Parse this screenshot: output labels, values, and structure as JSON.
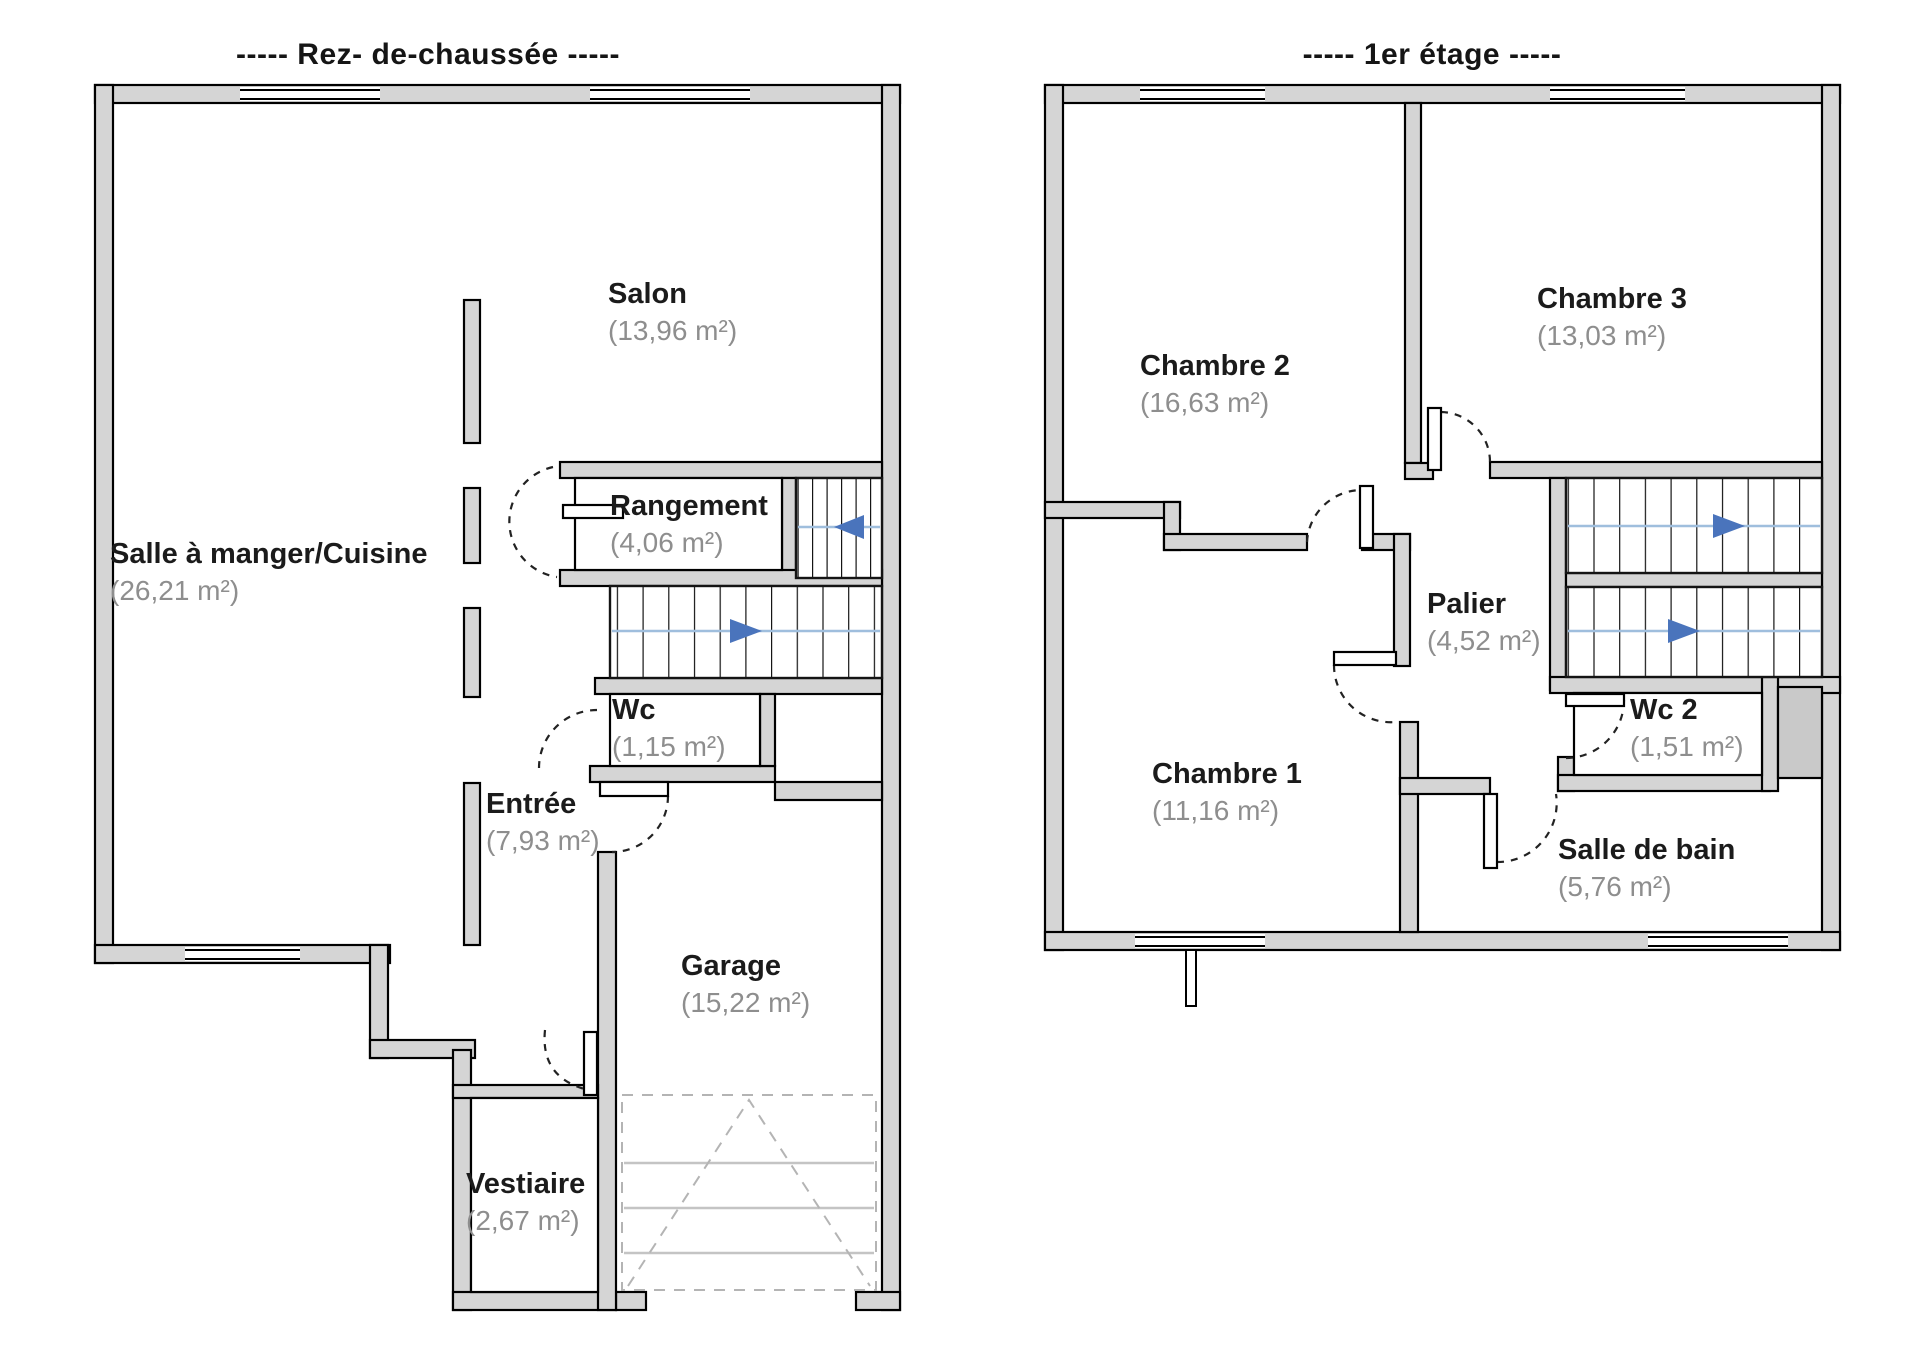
{
  "floors": [
    {
      "title": "-----  Rez- de-chaussée  -----",
      "rooms": [
        {
          "name": "Salon",
          "area": "(13,96 m²)"
        },
        {
          "name": "Salle à manger/Cuisine",
          "area": "(26,21 m²)"
        },
        {
          "name": "Rangement",
          "area": "(4,06 m²)"
        },
        {
          "name": "Wc",
          "area": "(1,15 m²)"
        },
        {
          "name": "Entrée",
          "area": "(7,93 m²)"
        },
        {
          "name": "Garage",
          "area": "(15,22 m²)"
        },
        {
          "name": "Vestiaire",
          "area": "(2,67 m²)"
        }
      ]
    },
    {
      "title": "-----  1er étage  -----",
      "rooms": [
        {
          "name": "Chambre 2",
          "area": "(16,63 m²)"
        },
        {
          "name": "Chambre 3",
          "area": "(13,03 m²)"
        },
        {
          "name": "Palier",
          "area": "(4,52 m²)"
        },
        {
          "name": "Chambre 1",
          "area": "(11,16 m²)"
        },
        {
          "name": "Wc 2",
          "area": "(1,51 m²)"
        },
        {
          "name": "Salle de bain",
          "area": "(5,76 m²)"
        }
      ]
    }
  ],
  "icons": {
    "stair_up_arrow": "solid blue triangle",
    "door_swing": "dashed quarter arc",
    "window": "double thin line in wall gap",
    "garage_door": "dashed chevron with horizontal rails"
  },
  "colors": {
    "wall_fill": "#d5d5d5",
    "wall_stroke": "#000000",
    "stair_arrow": "#4a74bc",
    "stair_guide": "#9fbedd",
    "room_name_text": "#1b1b1b",
    "room_area_text": "#8e8e8e",
    "garage_door_lines": "#b4b4b4"
  }
}
